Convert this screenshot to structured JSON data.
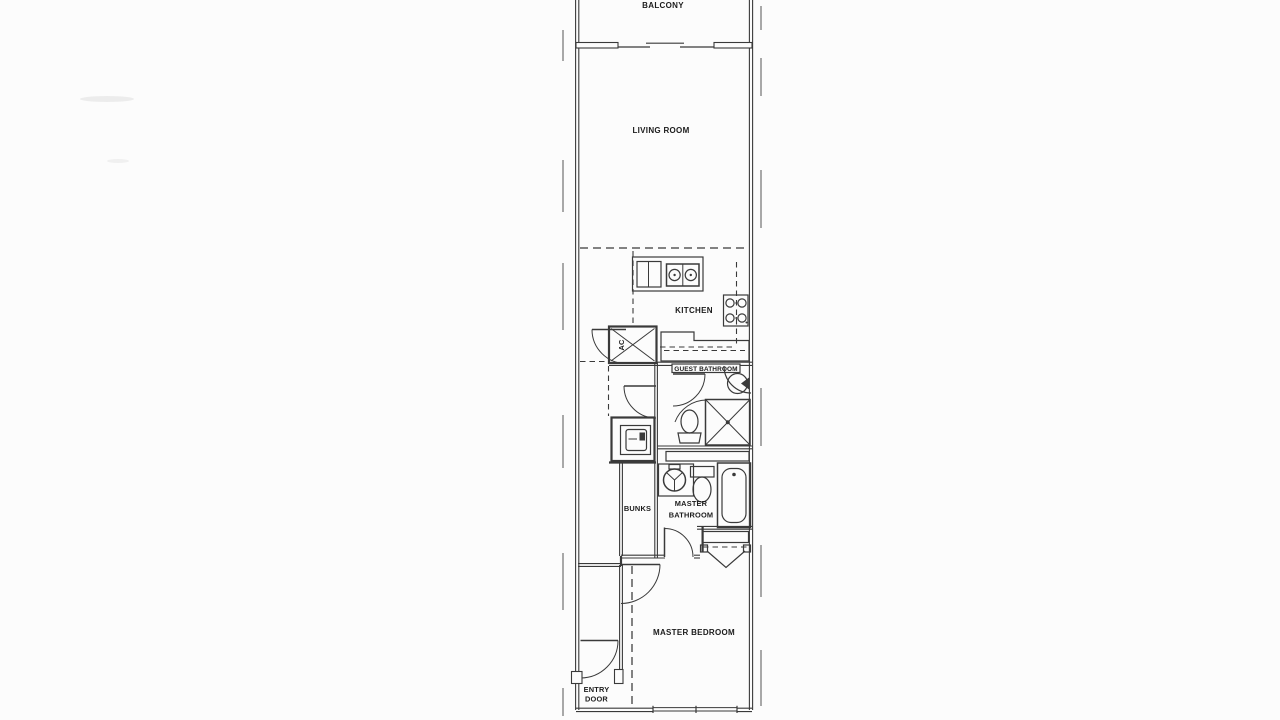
{
  "document": {
    "type": "scanned-floor-plan",
    "style": "architectural line drawing, one narrow condo unit"
  },
  "colors": {
    "paper": "#fcfcfc",
    "line": "#3a3a3a",
    "text": "#1c1c1c"
  },
  "floor_plan": {
    "rooms": [
      {
        "id": "balcony",
        "label": "BALCONY"
      },
      {
        "id": "living-room",
        "label": "LIVING ROOM"
      },
      {
        "id": "kitchen",
        "label": "KITCHEN"
      },
      {
        "id": "guest-bathroom",
        "label": "GUEST BATHROOM"
      },
      {
        "id": "bunks",
        "label": "BUNKS"
      },
      {
        "id": "master-bathroom",
        "label": "MASTER BATHROOM",
        "label_lines": [
          "MASTER",
          "BATHROOM"
        ]
      },
      {
        "id": "master-bedroom",
        "label": "MASTER BEDROOM"
      },
      {
        "id": "entry",
        "label": "ENTRY DOOR",
        "label_lines": [
          "ENTRY",
          "DOOR"
        ]
      },
      {
        "id": "ac-closet",
        "label": "AC"
      }
    ],
    "fixtures": [
      {
        "name": "sliding-glass-door",
        "room": "balcony"
      },
      {
        "name": "refrigerator-icon",
        "room": "kitchen"
      },
      {
        "name": "double-sink-icon",
        "room": "kitchen"
      },
      {
        "name": "stove-burners-icon",
        "room": "kitchen"
      },
      {
        "name": "ac-unit-icon",
        "room": "ac-closet"
      },
      {
        "name": "washer-icon",
        "room": "laundry-closet"
      },
      {
        "name": "toilet-icon",
        "room": "guest-bathroom"
      },
      {
        "name": "corner-shower-icon",
        "room": "guest-bathroom"
      },
      {
        "name": "round-sink-icon",
        "room": "guest-bathroom"
      },
      {
        "name": "round-sink-icon",
        "room": "master-bathroom"
      },
      {
        "name": "toilet-icon",
        "room": "master-bathroom"
      },
      {
        "name": "bathtub-icon",
        "room": "master-bathroom"
      },
      {
        "name": "bifold-closet-doors",
        "room": "master-bedroom"
      },
      {
        "name": "window",
        "room": "master-bedroom"
      },
      {
        "name": "door-swing",
        "room": "entry"
      }
    ]
  }
}
